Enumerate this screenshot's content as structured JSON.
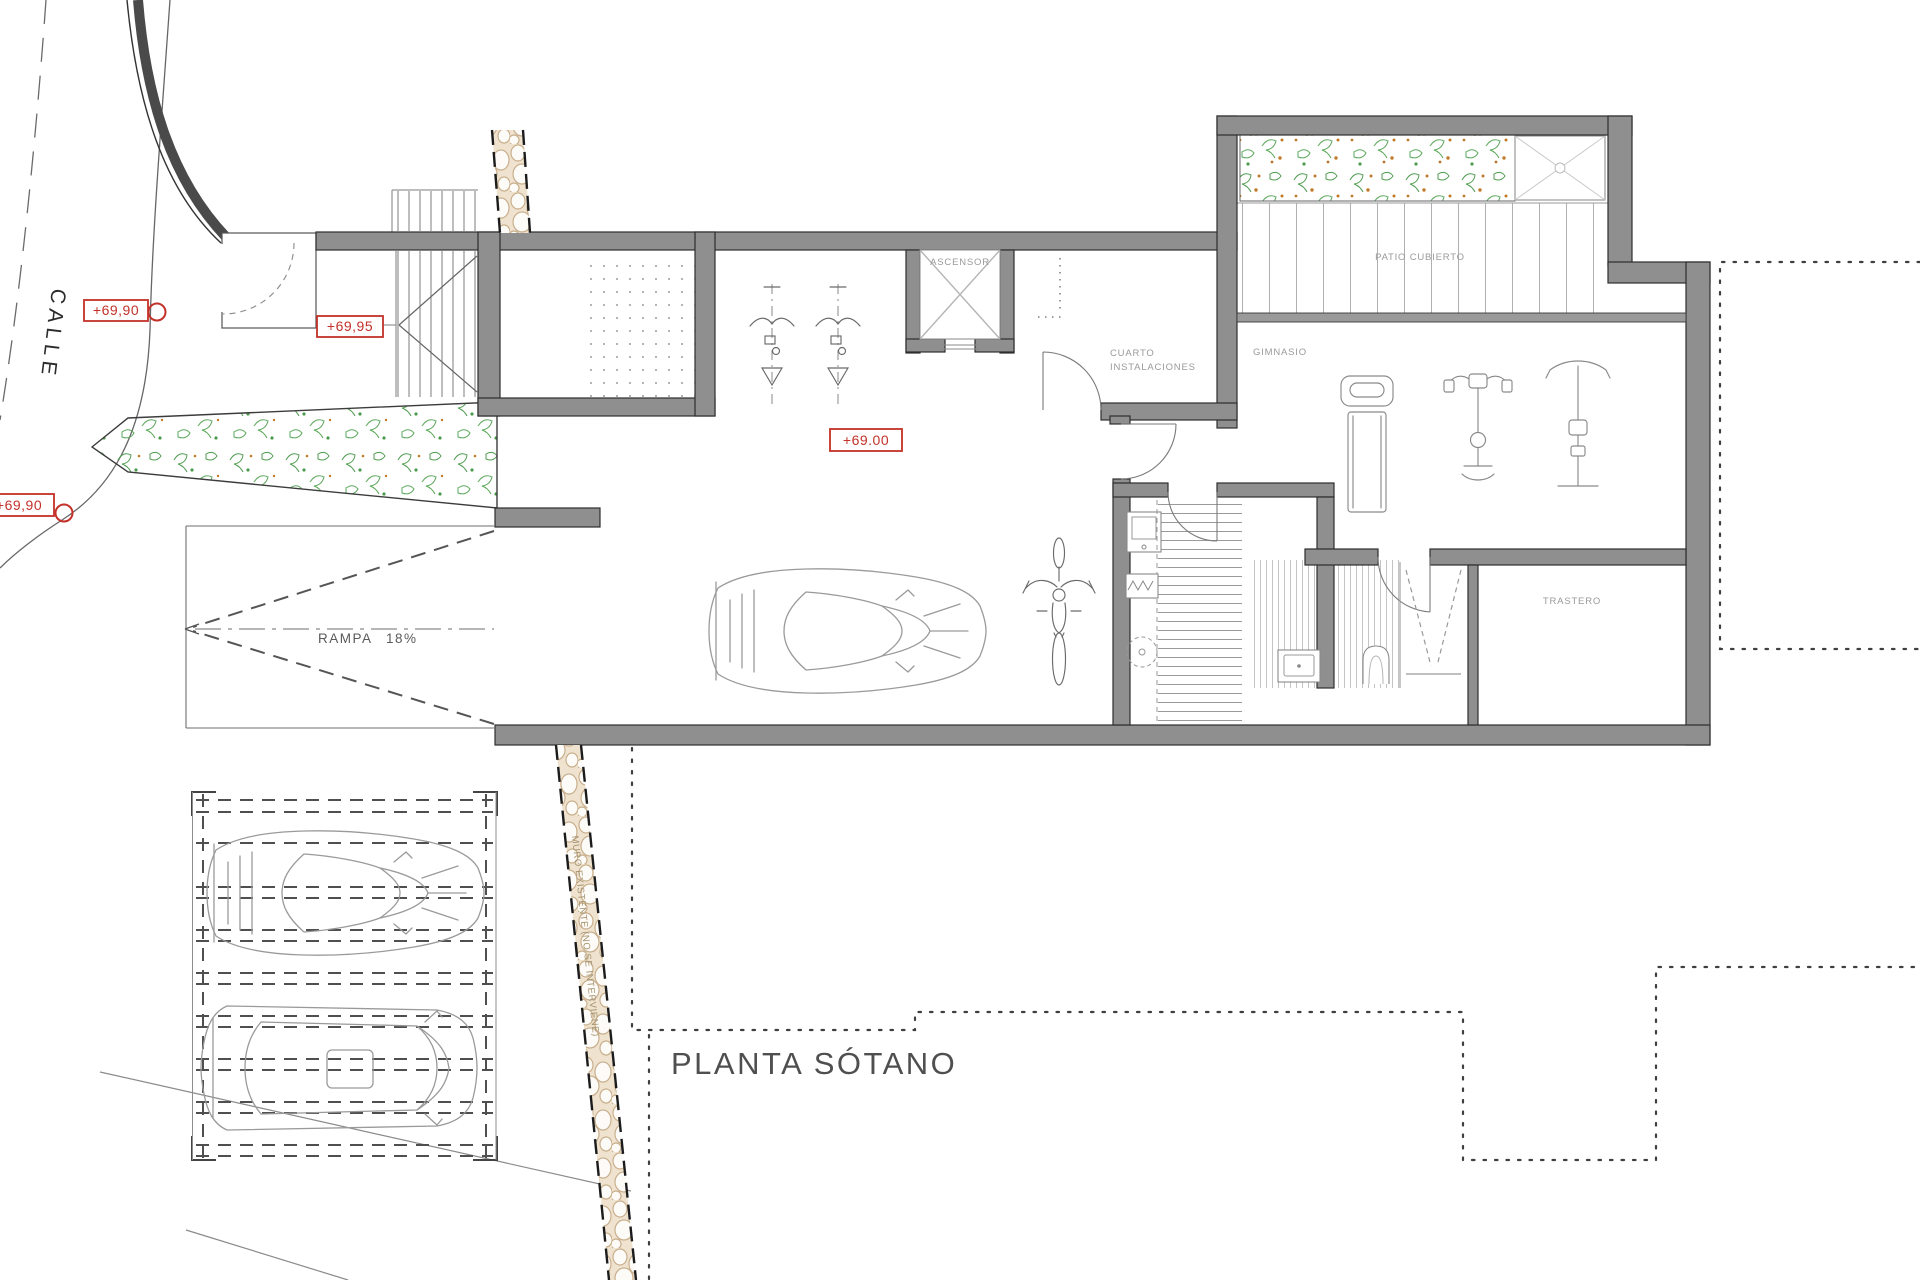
{
  "page": {
    "title": "PLANTA SÓTANO"
  },
  "street": {
    "label": "CALLE"
  },
  "elevation_markers": {
    "street_upper": "+69,90",
    "street_lower": "+69,90",
    "entry": "+69,95",
    "garage": "+69.00"
  },
  "ramp": {
    "label": "RAMPA 18%"
  },
  "rooms": {
    "elevator": "ASCENSOR",
    "utility_line1": "CUARTO",
    "utility_line2": "INSTALACIONES",
    "gym": "GIMNASIO",
    "covered_patio": "PATIO CUBIERTO",
    "storage": "TRASTERO"
  },
  "notes": {
    "existing_wall": "MURO EXISTENTE (NO SE INTERVIENE)"
  },
  "colors": {
    "wall_fill": "#8f8f8f",
    "wall_outline": "#2e2e2e",
    "marker_red": "#c3312a",
    "plant_green": "#4e9b4e",
    "plant_orange": "#c07a28",
    "stone_tan": "#c9af8d",
    "line_gray": "#8a8a8a"
  }
}
